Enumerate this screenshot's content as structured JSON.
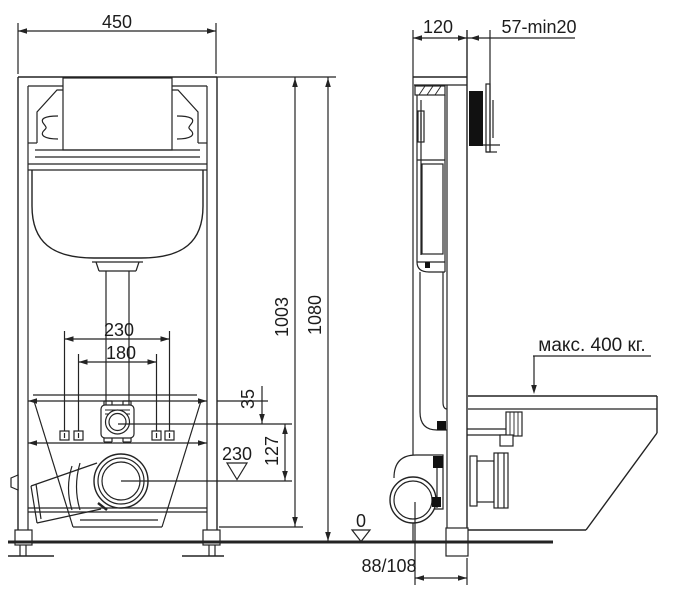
{
  "page": {
    "background": "#ffffff",
    "line_color": "#232323",
    "actuator_plate_color": "#111111"
  },
  "labels": {
    "front_width": "450",
    "side_depth": "120",
    "side_panel_range": "57-min20",
    "bolt_spacing_outer": "230",
    "bolt_spacing_inner": "180",
    "frame_height": "1003",
    "overall_height": "1080",
    "flush_offset": "35",
    "flush_to_drain": "127",
    "drain_level": "230",
    "floor_level": "0",
    "drain_distance": "88/108",
    "max_load": "макс. 400 кг."
  }
}
